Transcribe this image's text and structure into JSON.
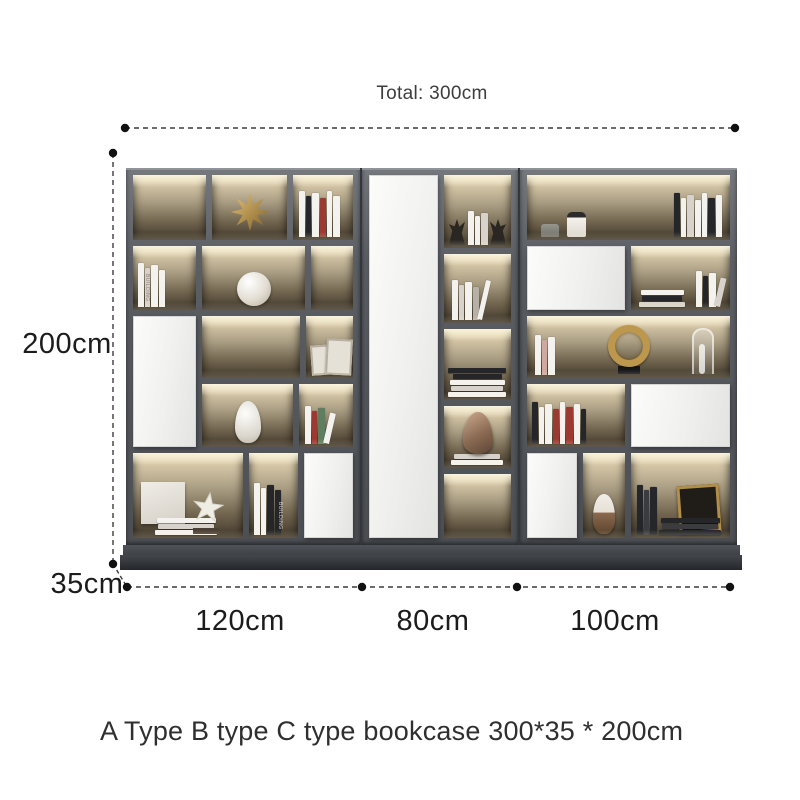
{
  "annotations": {
    "total_label": "Total: 300cm",
    "height_label": "200cm",
    "depth_label": "35cm",
    "widths": [
      "120cm",
      "80cm",
      "100cm"
    ],
    "caption": "A Type B type C type bookcase 300*35 * 200cm"
  },
  "bookcase": {
    "book_spine_label": "BUILDING",
    "sections": [
      {
        "name": "A",
        "width_label": "120cm"
      },
      {
        "name": "B",
        "width_label": "80cm"
      },
      {
        "name": "C",
        "width_label": "100cm"
      }
    ],
    "colors": {
      "frame": "#55585d",
      "door": "#f1f1ef",
      "warm_glow": "#f3e6c4",
      "gold_accent": "#bd984c",
      "base": "#34373b",
      "dimension_line": "#3c3c3c"
    }
  }
}
